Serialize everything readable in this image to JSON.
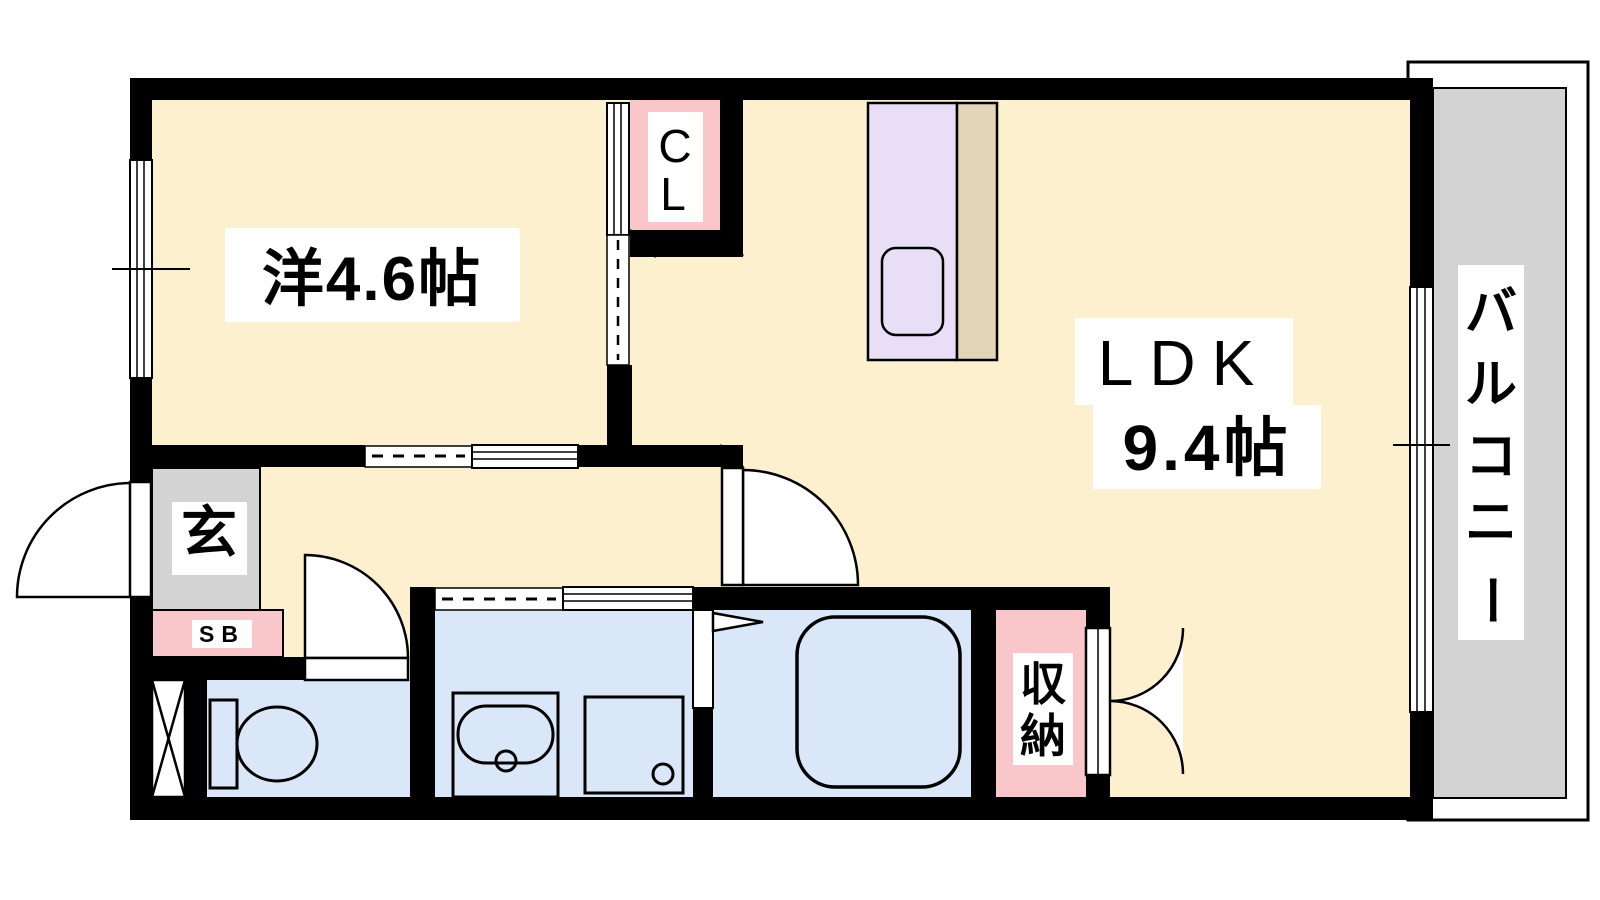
{
  "floorplan": {
    "type": "apartment-floor-plan",
    "rooms": {
      "western_room": {
        "label": "洋4.6帖"
      },
      "ldk": {
        "line1": "LDK",
        "line2": "9.4帖"
      },
      "closet": {
        "char1": "C",
        "char2": "L"
      },
      "entrance": {
        "label": "玄"
      },
      "shoe_box": {
        "label": "SB"
      },
      "storage": {
        "char1": "収",
        "char2": "納"
      },
      "balcony": {
        "char1": "バ",
        "char2": "ル",
        "char3": "コ",
        "char4": "ニ",
        "char5": "ー"
      }
    },
    "colors": {
      "floor_cream": "#FCF0CE",
      "wet_area_blue": "#DAE7F8",
      "accent_pink": "#F9C7C9",
      "gray": "#D3D3D3",
      "kitchen_lavender": "#E8DFF6",
      "counter_beige": "#E3D5B8",
      "wall_black": "#000000",
      "label_bg": "#FFFFFF"
    }
  }
}
